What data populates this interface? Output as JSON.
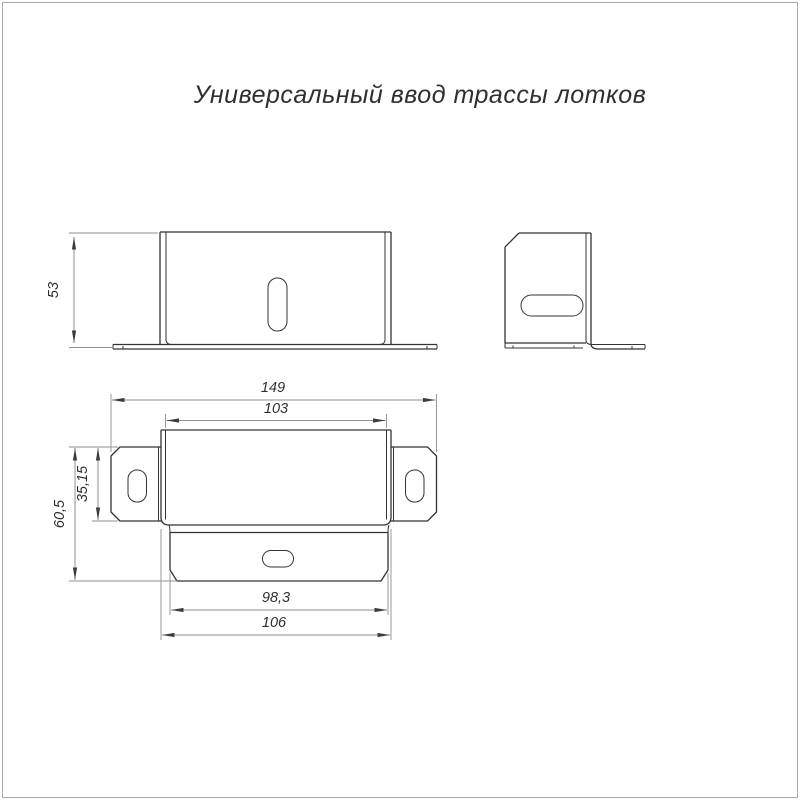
{
  "title": "Универсальный ввод трассы лотков",
  "drawing": {
    "views": {
      "front": {
        "dims": {
          "height": "53"
        }
      },
      "side": {
        "dims": {}
      },
      "plan": {
        "dims": {
          "overall_width": "149",
          "inner_width": "103",
          "wing_height": "35,15",
          "overall_length": "60,5",
          "flap_width": "98,3",
          "body_width": "106"
        }
      }
    }
  },
  "colors": {
    "background": "#ffffff",
    "frame": "#a9a9a9",
    "outline": "#333333",
    "dimension": "#8f8f8f",
    "text": "#2f2f2f",
    "arrow": "#3c3c3c"
  }
}
